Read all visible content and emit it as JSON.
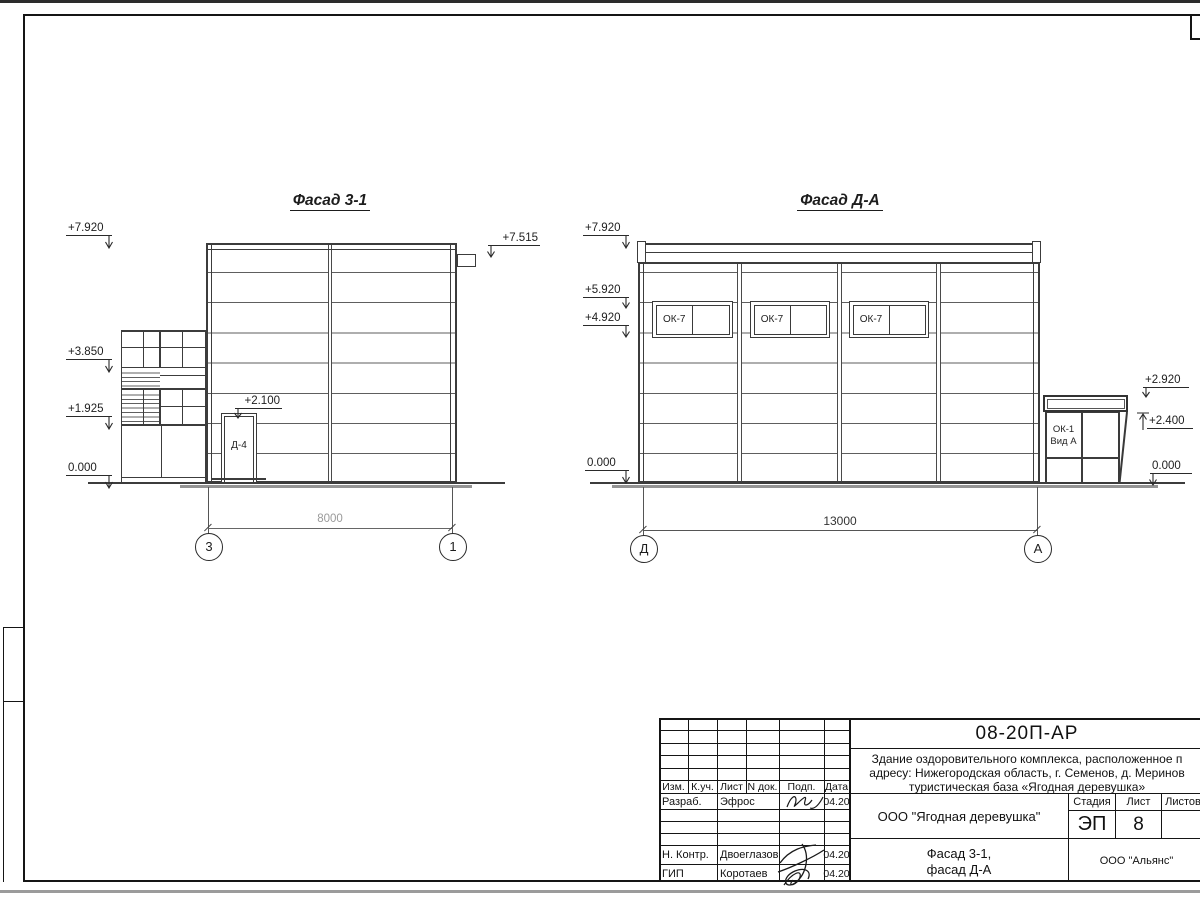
{
  "views": {
    "left": {
      "title": "Фасад 3-1",
      "marks": {
        "m7920": "+7.920",
        "m3850": "+3.850",
        "m1925": "+1.925",
        "m0": "0.000",
        "door": "+2.100",
        "vent": "+7.515"
      },
      "door_label": "Д-4",
      "dim": "8000",
      "axis_a": "3",
      "axis_b": "1"
    },
    "right": {
      "title": "Фасад Д-А",
      "marks": {
        "m7920": "+7.920",
        "m5920": "+5.920",
        "m4920": "+4.920",
        "m0l": "0.000",
        "m2920": "+2.920",
        "m2400": "+2.400",
        "m0r": "0.000"
      },
      "windows": {
        "w1": "ОК-7",
        "w2": "ОК-7",
        "w3": "ОК-7"
      },
      "porch": {
        "line1": "ОК-1",
        "line2": "Вид А"
      },
      "dim": "13000",
      "axis_a": "Д",
      "axis_b": "А"
    }
  },
  "titleblock": {
    "doc_code": "08-20П-АР",
    "description": {
      "line1": "Здание оздоровительного комплекса, расположенное п",
      "line2": "адресу: Нижегородская область, г. Семенов, д. Меринов",
      "line3": "туристическая база «Ягодная деревушка»"
    },
    "header": {
      "izm": "Изм.",
      "kuch": "К.уч.",
      "list": "Лист",
      "ndok": "N док.",
      "podp": "Подп.",
      "data": "Дата"
    },
    "rows": {
      "razrab": {
        "role": "Разраб.",
        "name": "Эфрос",
        "date": "04.20"
      },
      "nkontr": {
        "role": "Н. Контр.",
        "name": "Двоеглазов",
        "date": "04.20"
      },
      "gip": {
        "role": "ГИП",
        "name": "Коротаев",
        "date": "04.20"
      }
    },
    "org": "ООО \"Ягодная деревушка\"",
    "stage_header": {
      "stage": "Стадия",
      "sheet": "Лист",
      "sheets": "Листов"
    },
    "stage": "ЭП",
    "sheet_no": "8",
    "drawing_name": {
      "line1": "Фасад 3-1,",
      "line2": "фасад Д-А"
    },
    "firm": "ООО \"Альянс\""
  }
}
